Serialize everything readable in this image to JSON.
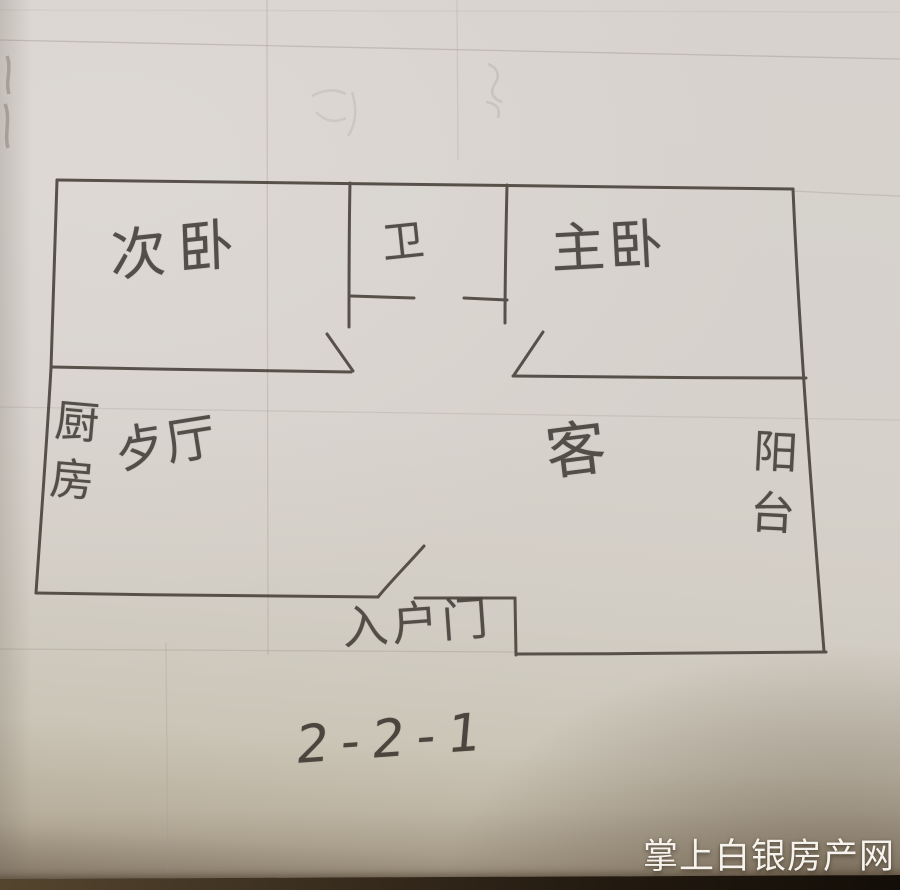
{
  "rooms": {
    "secondary_bedroom": "次卧",
    "bathroom": "卫",
    "master_bedroom": "主卧",
    "kitchen": "厨房",
    "dining_hall": "歺厅",
    "living_room": "客",
    "balcony": "阳台",
    "entrance": "入户门"
  },
  "annotation": {
    "layout_code": "2-2-1"
  },
  "watermark": {
    "text": "掌上白银房产网"
  },
  "colors": {
    "paper": "#d5d0c9",
    "pencil": "#49433c",
    "watermark_text": "#f6f3ee",
    "photo_edge": "#1a130c"
  }
}
